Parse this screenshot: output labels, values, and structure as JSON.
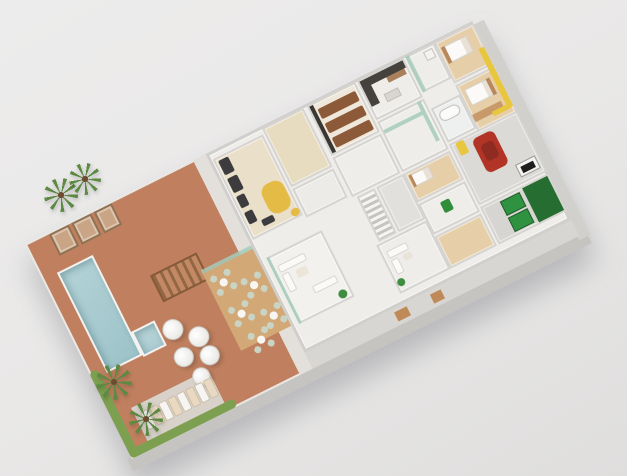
{
  "meta": {
    "description": "3D isometric floor-plan render of a residential amenity level with pool deck, gym, cinema, party lounge, bedrooms, garage and service areas on a plain gray backdrop"
  },
  "palette": {
    "background": "#e9e8e7",
    "deck": "#c0805f",
    "wall": "#d6d4d0",
    "floor": "#efedea",
    "wood": "#d2a877",
    "woodFloor": "#e6cfa8",
    "gymFloor": "#eadfc9",
    "equipment": "#3c3c3e",
    "sofaYellow": "#e4bb45",
    "seatBrown": "#8d5a39",
    "stallCream": "#e7dcc0",
    "glassGreen": "#a4cbba",
    "chairSage": "#c9d4c4",
    "carRed": "#b23427",
    "binGreen": "#2f9240",
    "accentYellow": "#e8c63e",
    "hedge": "#7da050",
    "cabana": "#c9a585",
    "poolWater": "#a5c8cc",
    "sideFace": "#c6c4c1",
    "shadow": "rgba(100,100,112,0.35)"
  },
  "scene": {
    "building": {
      "cx": 302,
      "cy": 240,
      "width": 500,
      "height": 240,
      "rotation_deg": -26.5
    },
    "items": [
      {
        "n": "building-side-face-bottom",
        "x": -4,
        "y": 238,
        "w": 512,
        "h": 14,
        "f": "sideFace"
      },
      {
        "n": "building-side-face-right",
        "x": 498,
        "y": 4,
        "w": 13,
        "h": 240,
        "f": "#d2d0cd"
      },
      {
        "n": "pool-deck",
        "x": 0,
        "y": 0,
        "w": 202,
        "h": 240,
        "f": "deck",
        "cls": "deck-tex"
      },
      {
        "n": "deck-walkway",
        "x": 188,
        "y": 0,
        "w": 14,
        "h": 240,
        "f": "#e3e0dc"
      },
      {
        "n": "lounger-paving",
        "x": 22,
        "y": 194,
        "w": 86,
        "h": 38,
        "f": "#d8d2ca"
      },
      {
        "n": "hedge-left",
        "x": 0,
        "y": 144,
        "w": 9,
        "h": 96,
        "f": "hedge",
        "cls": "hedge"
      },
      {
        "n": "hedge-bottom",
        "x": 2,
        "y": 231,
        "w": 116,
        "h": 9,
        "f": "hedge",
        "cls": "hedge"
      },
      {
        "n": "cabana-1",
        "x": 26,
        "y": 2,
        "w": 22,
        "h": 24,
        "f": "cabana",
        "cls": "cab"
      },
      {
        "n": "cabana-2",
        "x": 51,
        "y": 2,
        "w": 22,
        "h": 24,
        "f": "cabana",
        "cls": "cab"
      },
      {
        "n": "cabana-3",
        "x": 76,
        "y": 2,
        "w": 20,
        "h": 24,
        "f": "cabana",
        "cls": "cab"
      },
      {
        "n": "swimming-pool",
        "x": 16,
        "y": 40,
        "w": 40,
        "h": 112,
        "cls": "pool"
      },
      {
        "n": "spa-pool",
        "x": 56,
        "y": 126,
        "w": 26,
        "h": 28,
        "cls": "pool spa"
      },
      {
        "n": "pergola",
        "x": 98,
        "y": 84,
        "w": 52,
        "h": 30,
        "cls": "pergola"
      },
      {
        "n": "wood-terrace",
        "x": 146,
        "y": 106,
        "w": 60,
        "h": 86,
        "f": "wood",
        "cls": "wood-tex"
      },
      {
        "n": "terrace-glass-wall",
        "x": 146,
        "y": 102,
        "w": 60,
        "h": 4,
        "f": "glassGreen",
        "cls": "glass"
      },
      {
        "n": "umbrella",
        "x": 84,
        "y": 132,
        "w": 21,
        "h": 21,
        "cls": "umbrella"
      },
      {
        "n": "umbrella",
        "x": 104,
        "y": 150,
        "w": 21,
        "h": 21,
        "cls": "umbrella"
      },
      {
        "n": "umbrella",
        "x": 82,
        "y": 162,
        "w": 20,
        "h": 20,
        "cls": "umbrella"
      },
      {
        "n": "umbrella",
        "x": 106,
        "y": 172,
        "w": 20,
        "h": 20,
        "cls": "umbrella"
      },
      {
        "n": "umbrella",
        "x": 90,
        "y": 188,
        "w": 18,
        "h": 18,
        "cls": "umbrella"
      },
      {
        "n": "sun-lounger",
        "x": 28,
        "y": 202,
        "w": 9,
        "h": 20,
        "f": "#f6f5f3",
        "cls": "lounger"
      },
      {
        "n": "sun-lounger",
        "x": 38,
        "y": 202,
        "w": 9,
        "h": 20,
        "f": "#ead9c2",
        "cls": "lounger"
      },
      {
        "n": "sun-lounger",
        "x": 48,
        "y": 202,
        "w": 9,
        "h": 20,
        "f": "#f6f5f3",
        "cls": "lounger"
      },
      {
        "n": "sun-lounger",
        "x": 58,
        "y": 202,
        "w": 9,
        "h": 20,
        "f": "#ead9c2",
        "cls": "lounger"
      },
      {
        "n": "sun-lounger",
        "x": 68,
        "y": 202,
        "w": 9,
        "h": 20,
        "f": "#f6f5f3",
        "cls": "lounger"
      },
      {
        "n": "sun-lounger",
        "x": 78,
        "y": 202,
        "w": 9,
        "h": 20,
        "f": "#ead9c2",
        "cls": "lounger"
      },
      {
        "n": "sun-lounger",
        "x": 88,
        "y": 202,
        "w": 9,
        "h": 20,
        "f": "#f6f5f3",
        "cls": "lounger"
      },
      {
        "n": "sun-lounger",
        "x": 98,
        "y": 202,
        "w": 9,
        "h": 20,
        "f": "#ead9c2",
        "cls": "lounger"
      },
      {
        "n": "chair-cluster",
        "x": 150,
        "y": 112,
        "w": 22,
        "h": 22,
        "cls": "cluster"
      },
      {
        "n": "chair-cluster",
        "x": 176,
        "y": 128,
        "w": 22,
        "h": 22,
        "cls": "cluster"
      },
      {
        "n": "chair-cluster",
        "x": 152,
        "y": 148,
        "w": 22,
        "h": 22,
        "cls": "cluster"
      },
      {
        "n": "chair-cluster",
        "x": 180,
        "y": 164,
        "w": 22,
        "h": 22,
        "cls": "cluster"
      },
      {
        "n": "chair-cluster",
        "x": 158,
        "y": 180,
        "w": 22,
        "h": 22,
        "cls": "cluster"
      },
      {
        "n": "indoor-floor",
        "x": 202,
        "y": 0,
        "w": 298,
        "h": 222,
        "f": "floor",
        "cls": "room outer"
      },
      {
        "n": "service-strip",
        "x": 202,
        "y": 222,
        "w": 298,
        "h": 18,
        "f": "#d8d6d2"
      },
      {
        "n": "service-door",
        "x": 300,
        "y": 226,
        "w": 14,
        "h": 10,
        "f": "#c08a58"
      },
      {
        "n": "service-door",
        "x": 340,
        "y": 226,
        "w": 12,
        "h": 10,
        "f": "#c08a58"
      },
      {
        "n": "gym",
        "x": 206,
        "y": 8,
        "w": 56,
        "h": 90,
        "f": "gymFloor",
        "cls": "room"
      },
      {
        "n": "changing-stalls",
        "x": 264,
        "y": 2,
        "w": 46,
        "h": 66,
        "f": "stallCream",
        "cls": "room stalls"
      },
      {
        "n": "wc-room",
        "x": 264,
        "y": 70,
        "w": 46,
        "h": 32,
        "f": "#ecebe7",
        "cls": "room"
      },
      {
        "n": "cinema-room",
        "x": 314,
        "y": 2,
        "w": 54,
        "h": 56,
        "f": "#efe8da",
        "cls": "room"
      },
      {
        "n": "hall-mid",
        "x": 314,
        "y": 60,
        "w": 54,
        "h": 44,
        "f": "floor",
        "cls": "room"
      },
      {
        "n": "staircase",
        "x": 318,
        "y": 106,
        "w": 20,
        "h": 50,
        "cls": "stairs"
      },
      {
        "n": "elevator-core",
        "x": 340,
        "y": 106,
        "w": 30,
        "h": 50,
        "f": "#e2e0dc",
        "cls": "room"
      },
      {
        "n": "party-room",
        "x": 210,
        "y": 120,
        "w": 62,
        "h": 74,
        "f": "#f3f1ee",
        "cls": "room"
      },
      {
        "n": "party-glass-wall",
        "x": 210,
        "y": 120,
        "w": 3,
        "h": 74,
        "f": "glassGreen",
        "cls": "glass"
      },
      {
        "n": "kitchen",
        "x": 370,
        "y": 2,
        "w": 52,
        "h": 44,
        "f": "floor",
        "cls": "room"
      },
      {
        "n": "laundry",
        "x": 424,
        "y": 2,
        "w": 32,
        "h": 40,
        "f": "floor",
        "cls": "room"
      },
      {
        "n": "suite-bedroom",
        "x": 456,
        "y": 2,
        "w": 44,
        "h": 46,
        "f": "woodFloor",
        "cls": "room"
      },
      {
        "n": "hall-right",
        "x": 370,
        "y": 48,
        "w": 52,
        "h": 56,
        "f": "floor",
        "cls": "room"
      },
      {
        "n": "bathroom",
        "x": 424,
        "y": 60,
        "w": 32,
        "h": 38,
        "f": "#eef0ef",
        "cls": "room"
      },
      {
        "n": "bedroom-2",
        "x": 456,
        "y": 50,
        "w": 44,
        "h": 52,
        "f": "woodFloor",
        "cls": "room"
      },
      {
        "n": "bedroom-3",
        "x": 370,
        "y": 106,
        "w": 52,
        "h": 32,
        "f": "woodFloor",
        "cls": "room"
      },
      {
        "n": "utility-room",
        "x": 370,
        "y": 140,
        "w": 52,
        "h": 34,
        "f": "floor",
        "cls": "room"
      },
      {
        "n": "maid-room",
        "x": 370,
        "y": 176,
        "w": 52,
        "h": 36,
        "f": "woodFloor",
        "cls": "room"
      },
      {
        "n": "living-room",
        "x": 314,
        "y": 158,
        "w": 56,
        "h": 54,
        "f": "floor",
        "cls": "room"
      },
      {
        "n": "garage",
        "x": 424,
        "y": 100,
        "w": 76,
        "h": 68,
        "f": "#dcdad6",
        "cls": "room"
      },
      {
        "n": "bins-room",
        "x": 424,
        "y": 170,
        "w": 76,
        "h": 42,
        "f": "#d7d5d1",
        "cls": "room"
      },
      {
        "n": "gym-equipment",
        "x": 210,
        "y": 12,
        "w": 11,
        "h": 16,
        "f": "equipment",
        "r": 2
      },
      {
        "n": "gym-equipment",
        "x": 210,
        "y": 32,
        "w": 11,
        "h": 16,
        "f": "equipment",
        "r": 2
      },
      {
        "n": "gym-equipment",
        "x": 210,
        "y": 52,
        "w": 9,
        "h": 13,
        "f": "equipment",
        "r": 2
      },
      {
        "n": "gym-equipment",
        "x": 210,
        "y": 70,
        "w": 9,
        "h": 13,
        "f": "equipment",
        "r": 2
      },
      {
        "n": "gym-bench",
        "x": 222,
        "y": 84,
        "w": 13,
        "h": 7,
        "f": "equipment",
        "r": 2
      },
      {
        "n": "gym-sofa",
        "x": 234,
        "y": 54,
        "w": 24,
        "h": 32,
        "f": "sofaYellow",
        "r": 10
      },
      {
        "n": "gym-pouf",
        "x": 252,
        "y": 88,
        "w": 9,
        "h": 8,
        "f": "sofaYellow",
        "r": 4
      },
      {
        "n": "cinema-screen",
        "x": 316,
        "y": 4,
        "w": 4,
        "h": 52,
        "f": "#3a3733"
      },
      {
        "n": "cinema-seat-row",
        "x": 322,
        "y": 10,
        "w": 42,
        "h": 11,
        "f": "seatBrown",
        "cls": "seats"
      },
      {
        "n": "cinema-seat-row",
        "x": 322,
        "y": 26,
        "w": 42,
        "h": 11,
        "f": "seatBrown",
        "cls": "seats"
      },
      {
        "n": "cinema-seat-row",
        "x": 322,
        "y": 42,
        "w": 42,
        "h": 11,
        "f": "seatBrown",
        "cls": "seats"
      },
      {
        "n": "party-sofa",
        "x": 216,
        "y": 132,
        "w": 30,
        "h": 8,
        "f": "#fbfaf8",
        "r": 2,
        "b": "#d9d6d1"
      },
      {
        "n": "party-sofa",
        "x": 216,
        "y": 142,
        "w": 8,
        "h": 20,
        "f": "#fbfaf8",
        "r": 2,
        "b": "#d9d6d1"
      },
      {
        "n": "party-table",
        "x": 230,
        "y": 144,
        "w": 12,
        "h": 9,
        "f": "#ece5da",
        "r": 2
      },
      {
        "n": "party-sofa",
        "x": 238,
        "y": 166,
        "w": 26,
        "h": 8,
        "f": "#fbfaf8",
        "r": 2,
        "b": "#d9d6d1"
      },
      {
        "n": "party-plant",
        "x": 258,
        "y": 182,
        "w": 9,
        "h": 9,
        "f": "#3f8d3f",
        "r": 9
      },
      {
        "n": "kitchen-counter",
        "x": 372,
        "y": 4,
        "w": 48,
        "h": 8,
        "f": "#45413d"
      },
      {
        "n": "kitchen-counter",
        "x": 372,
        "y": 12,
        "w": 9,
        "h": 20,
        "f": "#45413d"
      },
      {
        "n": "kitchen-shelf",
        "x": 398,
        "y": 12,
        "w": 20,
        "h": 6,
        "f": "#a9805a"
      },
      {
        "n": "kitchen-island",
        "x": 388,
        "y": 26,
        "w": 16,
        "h": 9,
        "f": "#d9d5d0",
        "b": "#c1beba"
      },
      {
        "n": "laundry-glass",
        "x": 424,
        "y": 2,
        "w": 4,
        "h": 40,
        "f": "glassGreen",
        "cls": "glass"
      },
      {
        "n": "washer",
        "x": 442,
        "y": 6,
        "w": 10,
        "h": 10,
        "f": "#f4f3f1",
        "b": "#c5c3c0"
      },
      {
        "n": "suite-bed",
        "x": 462,
        "y": 10,
        "w": 26,
        "h": 18,
        "cls": "bed"
      },
      {
        "n": "suite-headboard",
        "x": 460,
        "y": 10,
        "w": 4,
        "h": 18,
        "f": "#b9875c"
      },
      {
        "n": "bedroom2-bed",
        "x": 462,
        "y": 58,
        "w": 26,
        "h": 18,
        "cls": "bed"
      },
      {
        "n": "bedroom2-headboard",
        "x": 486,
        "y": 58,
        "w": 4,
        "h": 18,
        "f": "#b9875c"
      },
      {
        "n": "wardrobe",
        "x": 458,
        "y": 84,
        "w": 32,
        "h": 8,
        "f": "#c89a6a"
      },
      {
        "n": "bathtub",
        "x": 428,
        "y": 66,
        "w": 22,
        "h": 12,
        "f": "#fbfbfa",
        "b": "#c3c1be",
        "r": 6
      },
      {
        "n": "hall-glass-partition",
        "x": 372,
        "y": 58,
        "w": 42,
        "h": 4,
        "f": "glassGreen",
        "cls": "glass"
      },
      {
        "n": "hall-glass-partition",
        "x": 414,
        "y": 48,
        "w": 4,
        "h": 44,
        "f": "glassGreen",
        "cls": "glass"
      },
      {
        "n": "yellow-shaft-wall",
        "x": 493,
        "y": 28,
        "w": 6,
        "h": 66,
        "f": "accentYellow"
      },
      {
        "n": "yellow-shaft-wall",
        "x": 477,
        "y": 90,
        "w": 20,
        "h": 5,
        "f": "accentYellow"
      },
      {
        "n": "bedroom3-bed",
        "x": 374,
        "y": 110,
        "w": 22,
        "h": 13,
        "cls": "bed"
      },
      {
        "n": "bedroom3-headboard",
        "x": 374,
        "y": 110,
        "w": 3,
        "h": 13,
        "f": "#b9875c"
      },
      {
        "n": "living-sofa",
        "x": 320,
        "y": 168,
        "w": 22,
        "h": 8,
        "f": "#fbfaf8",
        "r": 2,
        "b": "#d9d6d1"
      },
      {
        "n": "living-sofa",
        "x": 320,
        "y": 178,
        "w": 8,
        "h": 16,
        "f": "#fbfaf8",
        "r": 2,
        "b": "#d9d6d1"
      },
      {
        "n": "living-table",
        "x": 333,
        "y": 178,
        "w": 9,
        "h": 7,
        "f": "#e9e3d9",
        "r": 2
      },
      {
        "n": "living-plant",
        "x": 316,
        "y": 198,
        "w": 8,
        "h": 8,
        "f": "#3f8d3f",
        "r": 8
      },
      {
        "n": "utility-plant",
        "x": 390,
        "y": 148,
        "w": 10,
        "h": 12,
        "f": "#2f8d3c",
        "r": 2
      },
      {
        "n": "car",
        "x": 446,
        "y": 106,
        "w": 24,
        "h": 38,
        "f": "carRed",
        "r": 6
      },
      {
        "n": "car-roof",
        "x": 451,
        "y": 115,
        "w": 14,
        "h": 18,
        "f": "#8f2b21",
        "r": 4
      },
      {
        "n": "garage-gate",
        "x": 474,
        "y": 148,
        "w": 22,
        "h": 14,
        "f": "#f4f4f2",
        "b": "#9b9997"
      },
      {
        "n": "garage-gate-panel",
        "x": 478,
        "y": 152,
        "w": 14,
        "h": 7,
        "f": "#1e1e1e"
      },
      {
        "n": "scooter",
        "x": 430,
        "y": 102,
        "w": 9,
        "h": 14,
        "f": "accentYellow",
        "r": 2
      },
      {
        "n": "bin-hedge",
        "x": 470,
        "y": 172,
        "w": 28,
        "h": 38,
        "f": "#256d31"
      },
      {
        "n": "waste-bin",
        "x": 444,
        "y": 174,
        "w": 22,
        "h": 16,
        "f": "binGreen",
        "b": "#1d5c28"
      },
      {
        "n": "waste-bin",
        "x": 444,
        "y": 192,
        "w": 22,
        "h": 16,
        "f": "binGreen",
        "b": "#1d5c28"
      }
    ],
    "palms": [
      {
        "x": 44,
        "y": 178,
        "s": 34
      },
      {
        "x": 69,
        "y": 163,
        "s": 32
      },
      {
        "x": 96,
        "y": 364,
        "s": 36
      },
      {
        "x": 129,
        "y": 402,
        "s": 34
      }
    ]
  }
}
